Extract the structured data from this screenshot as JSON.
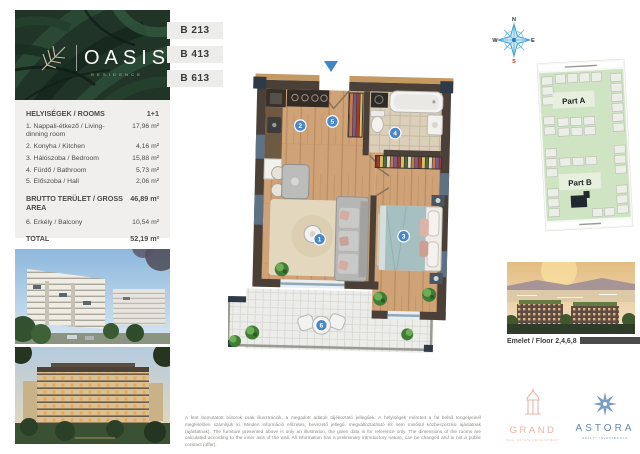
{
  "brand": {
    "name": "OASIS",
    "subtitle": "RESIDENCE"
  },
  "units": [
    "B 213",
    "B 413",
    "B 613"
  ],
  "rooms": {
    "header": "HELYISÉGEK / ROOMS",
    "header_value": "1+1",
    "items": [
      {
        "label": "1. Nappali-étkező / Living-dinning room",
        "value": "17,96 m²"
      },
      {
        "label": "2. Konyha / Kitchen",
        "value": "4,16 m²"
      },
      {
        "label": "3. Hálószoba / Bedroom",
        "value": "15,88 m²"
      },
      {
        "label": "4. Fürdő / Bathroom",
        "value": "5,73 m²"
      },
      {
        "label": "5. Előszoba / Hall",
        "value": "2,06 m²"
      }
    ],
    "gross": {
      "label": "BRUTTO TERÜLET / GROSS AREA",
      "value": "46,89 m²"
    },
    "balcony": {
      "label": "6. Erkély / Balcony",
      "value": "10,54 m²"
    },
    "total": {
      "label": "TOTAL",
      "value": "52,19 m²"
    }
  },
  "plan": {
    "markers": [
      "1",
      "2",
      "3",
      "4",
      "5",
      "6"
    ]
  },
  "compass": {
    "n": "N",
    "e": "E",
    "w": "W",
    "s": "S"
  },
  "map": {
    "part_a": "Part A",
    "part_b": "Part B"
  },
  "floor_info": "Emelet / Floor 2,4,6,8",
  "disclaimer": {
    "hu": "A fent bemutatott bútorok csak illusztrációk, a megadott adatok tájékoztató jellegűek. A helyiségek méreteit a fal belső tengelyeinél megfelelően számítjuk ki. Minden információ előzetes, bevezető jellegű, megváltoztatható és nem minősül közbeszerzési ajánlatnak (ajánlatnak).",
    "en": "The furniture presented above is only an illustration, the given data is for reference only. The dimensions of the rooms are calculated according to the inner axis of the wall. All information has a preliminary introductory nature, can be changed and is not a public contract (offer)."
  },
  "logos": {
    "grand": {
      "name": "GRAND",
      "tagline": "REAL ESTATE DEVELOPMENT"
    },
    "astora": {
      "name": "ASTORA",
      "tagline": "REALTY INVESTMENTS"
    }
  },
  "colors": {
    "accent_blue": "#4a87c8",
    "wall": "#4a4037",
    "wood": "#cfa377",
    "leaf_green": "#203428",
    "map_green": "#cfe4c2",
    "grand_pink": "#e9b4a8",
    "astora_blue": "#6889ae",
    "bar_gray": "#4b4b4b"
  }
}
